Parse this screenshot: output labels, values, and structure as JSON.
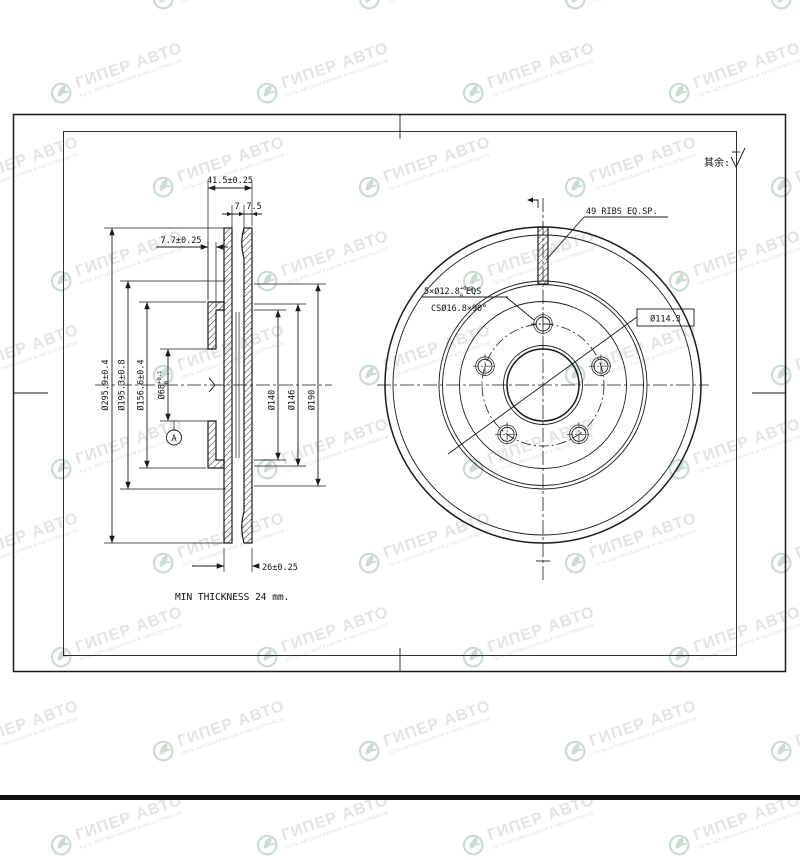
{
  "watermark": {
    "brand": "ГИПЕР АВТО",
    "tagline": "СЕТЬ АВТОМАГАЗИНОВ И АВТОСЕРВИСОВ"
  },
  "notes": {
    "surface_rest": "其余:",
    "min_thickness": "MIN THICKNESS 24 mm."
  },
  "section_view": {
    "height": "41.5±0.25",
    "plate_a": "7",
    "plate_b": "7.5",
    "flange_thickness": "7.7±0.25",
    "outer_dia": "Ø295.9±0.4",
    "transition_dia": "Ø195.3±0.8",
    "hat_dia": "Ø156.6±0.4",
    "bore": "Ø68",
    "bore_tol_top": "+0.1",
    "bore_tol_bot": "0",
    "dia_mid_1": "Ø140",
    "dia_mid_2": "Ø146",
    "dia_mid_3": "Ø190",
    "total_thickness": "26±0.25",
    "datum": "A"
  },
  "front_view": {
    "ribs": "49 RIBS EQ.SP.",
    "holes_prefix": "5×Ø12.8",
    "holes_tol_top": "+0.2",
    "holes_tol_bot": "0",
    "holes_suffix": "EQS",
    "countersink": "CSØ16.8×90°",
    "pcd": "Ø114.3"
  }
}
